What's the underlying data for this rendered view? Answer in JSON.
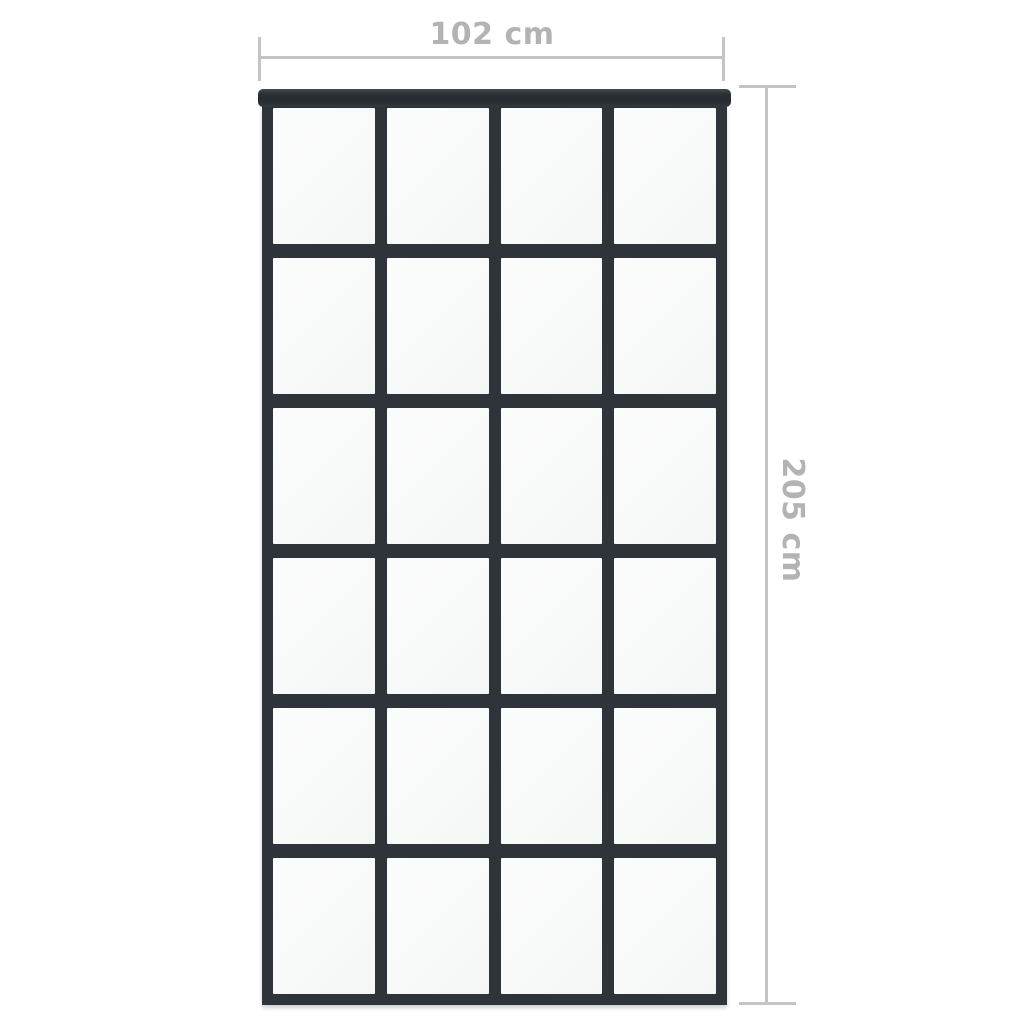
{
  "image": {
    "type": "product-dimension-diagram",
    "subject": "sliding-door-with-grid-glass-panes"
  },
  "dimensions": {
    "width": {
      "label": "102 cm",
      "orientation": "horizontal",
      "position": "top"
    },
    "height": {
      "label": "205 cm",
      "orientation": "vertical",
      "position": "right"
    }
  },
  "door": {
    "grid": {
      "rows": 6,
      "columns": 4,
      "pane_count": 24
    }
  },
  "colors": {
    "background": "#ffffff",
    "frame": "#2e343a",
    "top_rail": "#262b30",
    "glass": "#f8f9f9",
    "dimension_line": "#c4c4c4",
    "dimension_text": "#b3b3b3"
  }
}
